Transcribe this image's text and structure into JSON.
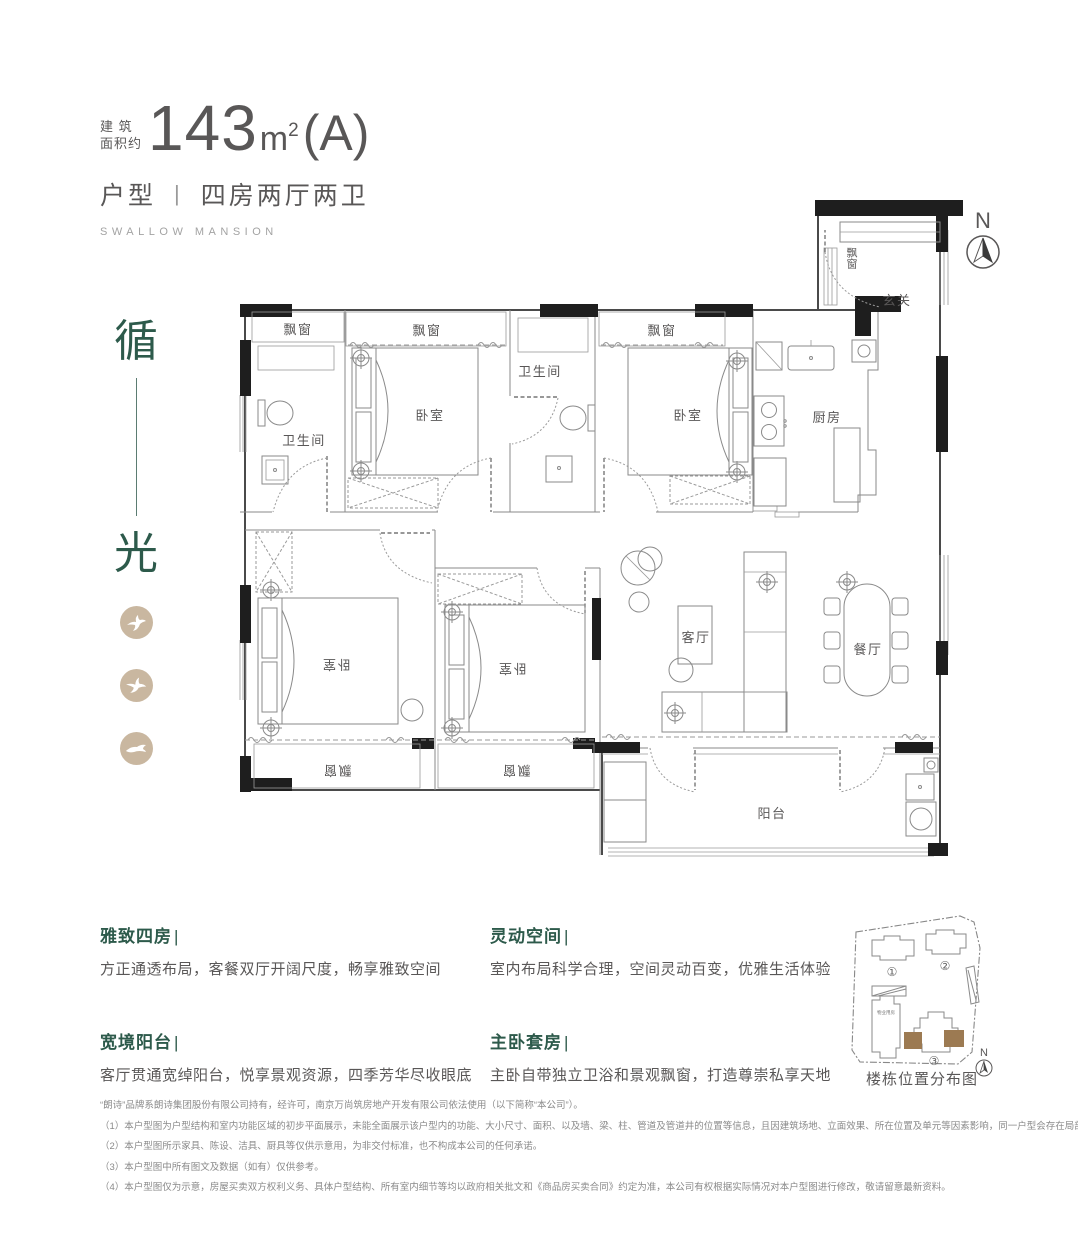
{
  "header": {
    "area_label_line1": "建 筑",
    "area_label_line2": "面积约",
    "area_value": "143",
    "area_unit_base": "m",
    "area_unit_sup": "2",
    "area_suffix": "(A)",
    "type_label": "户型",
    "type_divider": "|",
    "type_value": "四房两厅两卫",
    "subtitle_en": "SWALLOW MANSION"
  },
  "side_rail": {
    "char_top": "循",
    "char_bottom": "光"
  },
  "plan": {
    "compass": "N",
    "labels": {
      "bay": "飘窗",
      "bedroom": "卧室",
      "bath": "卫生间",
      "kitchen": "厨房",
      "living": "客厅",
      "dining": "餐厅",
      "balcony": "阳台",
      "entry": "玄关"
    }
  },
  "features": {
    "bar": "|",
    "items": [
      {
        "title": "雅致四房",
        "desc": "方正通透布局，客餐双厅开阔尺度，畅享雅致空间"
      },
      {
        "title": "宽境阳台",
        "desc": "客厅贯通宽绰阳台，悦享景观资源，四季芳华尽收眼底"
      },
      {
        "title": "灵动空间",
        "desc": "室内布局科学合理，空间灵动百变，优雅生活体验"
      },
      {
        "title": "主卧套房",
        "desc": "主卧自带独立卫浴和景观飘窗，打造尊崇私享天地"
      }
    ]
  },
  "site_map": {
    "caption": "楼栋位置分布图",
    "b1": "①",
    "b2": "②",
    "b3": "③",
    "small_label": "物业用房",
    "compass": "N",
    "highlight_color": "#9c7a52"
  },
  "disclaimer": [
    "“朗诗”品牌系朗诗集团股份有限公司持有，经许可，南京万尚筑房地产开发有限公司依法使用（以下简称“本公司”）。",
    "（1）本户型图为户型结构和室内功能区域的初步平面展示，未能全面展示该户型内的功能、大小尺寸、面积、以及墙、梁、柱、管道及管道井的位置等信息，且因建筑场地、立面效果、所在位置及单元等因素影响，同一户型会存在局部差异。",
    "（2）本户型图所示家具、陈设、洁具、厨具等仅供示意用，为非交付标准，也不构成本公司的任何承诺。",
    "（3）本户型图中所有图文及数据（如有）仅供参考。",
    "（4）本户型图仅为示意，房屋买卖双方权利义务、具体户型结构、所有室内细节等均以政府相关批文和《商品房买卖合同》约定为准，本公司有权根据实际情况对本户型图进行修改，敬请留意最新资料。"
  ],
  "colors": {
    "accent_green": "#2d5a4b",
    "tan": "#c9b7a0",
    "text_gray": "#595757"
  }
}
